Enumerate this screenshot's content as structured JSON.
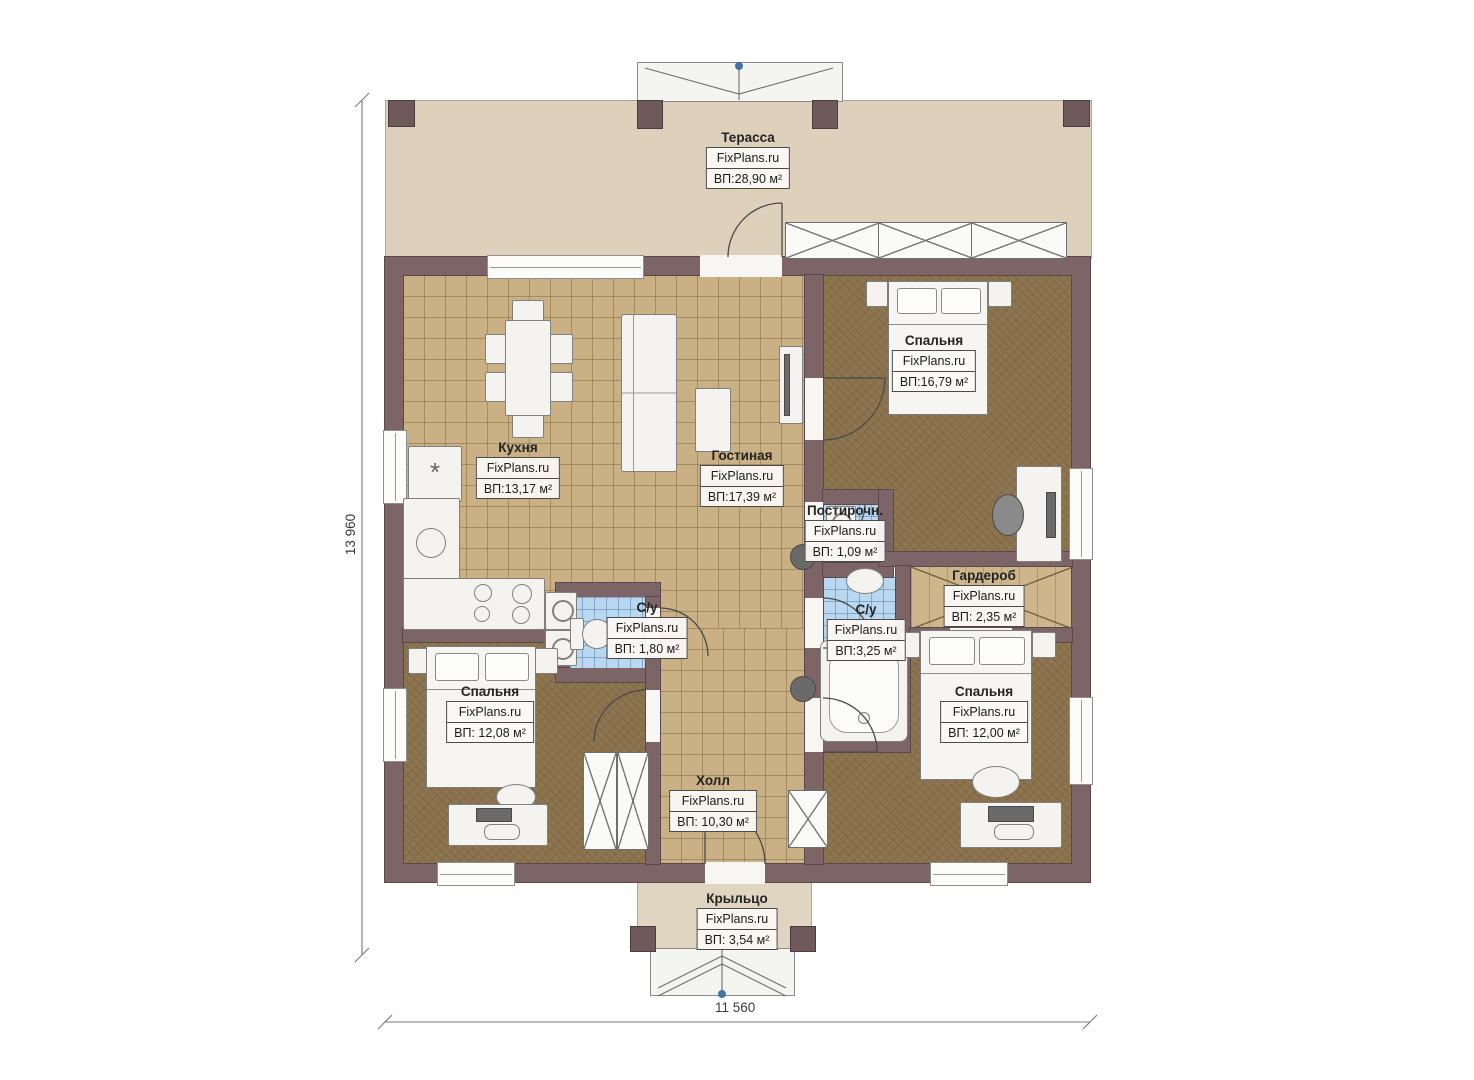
{
  "brand": "FixPlans.ru",
  "dimensions": {
    "vertical": "13 960",
    "horizontal": "11 560"
  },
  "rooms": {
    "terrace": {
      "name": "Терасса",
      "brand": "FixPlans.ru",
      "area": "ВП:28,90 м²"
    },
    "kitchen": {
      "name": "Кухня",
      "brand": "FixPlans.ru",
      "area": "ВП:13,17 м²"
    },
    "living": {
      "name": "Гостиная",
      "brand": "FixPlans.ru",
      "area": "ВП:17,39 м²"
    },
    "bedroom_top_right": {
      "name": "Спальня",
      "brand": "FixPlans.ru",
      "area": "ВП:16,79 м²"
    },
    "laundry": {
      "name": "Постирочн.",
      "brand": "FixPlans.ru",
      "area": "ВП: 1,09 м²"
    },
    "bath_small": {
      "name": "С/у",
      "brand": "FixPlans.ru",
      "area": "ВП: 1,80 м²"
    },
    "bath_large": {
      "name": "С/у",
      "brand": "FixPlans.ru",
      "area": "ВП:3,25 м²"
    },
    "wardrobe": {
      "name": "Гардероб",
      "brand": "FixPlans.ru",
      "area": "ВП: 2,35 м²"
    },
    "bedroom_bottom_left": {
      "name": "Спальня",
      "brand": "FixPlans.ru",
      "area": "ВП: 12,08 м²"
    },
    "bedroom_bottom_right": {
      "name": "Спальня",
      "brand": "FixPlans.ru",
      "area": "ВП: 12,00 м²"
    },
    "hall": {
      "name": "Холл",
      "brand": "FixPlans.ru",
      "area": "ВП: 10,30 м²"
    },
    "porch": {
      "name": "Крыльцо",
      "brand": "FixPlans.ru",
      "area": "ВП: 3,54 м²"
    }
  },
  "icons": {
    "fridge_mark": "*"
  }
}
